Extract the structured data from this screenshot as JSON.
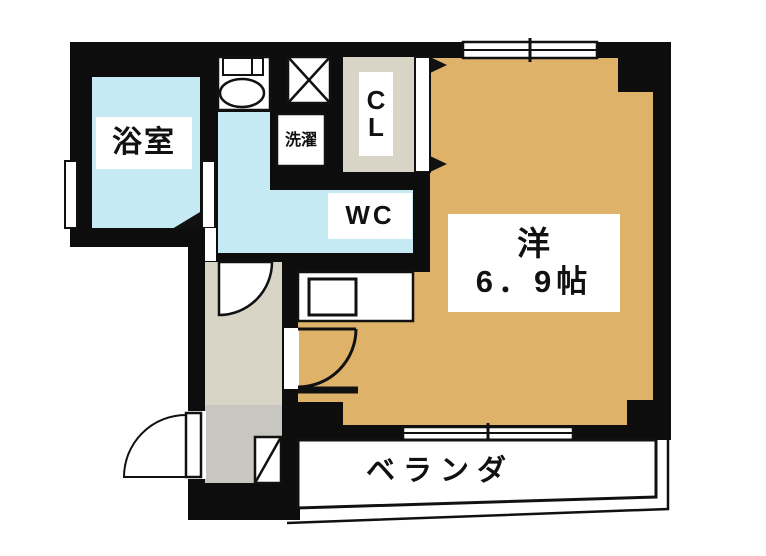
{
  "floor_plan": {
    "rooms": {
      "bathroom": {
        "label": "浴室"
      },
      "laundry": {
        "label": "洗濯"
      },
      "closet": {
        "label_top": "C",
        "label_bottom": "L"
      },
      "toilet": {
        "label": "WC"
      },
      "living": {
        "name": "洋",
        "size": "6．9帖"
      },
      "veranda": {
        "label": "ベランダ"
      }
    },
    "colors": {
      "wall": "#0d0d0d",
      "wet_area": "#c5eaf3",
      "living_floor": "#dfb269",
      "hall_floor": "#d8d5c6",
      "entry_floor": "#c7c6c1",
      "background": "#ffffff",
      "line": "#111111"
    },
    "fixtures": [
      "toilet-icon",
      "pipe-shaft-icon",
      "washer-pan",
      "kitchen-counter",
      "closet-doors",
      "entry-door-swing",
      "wc-door-swing",
      "kitchen-door-swing",
      "bathroom-door",
      "sliding-window-top",
      "sliding-window-bottom",
      "shoe-step"
    ]
  }
}
